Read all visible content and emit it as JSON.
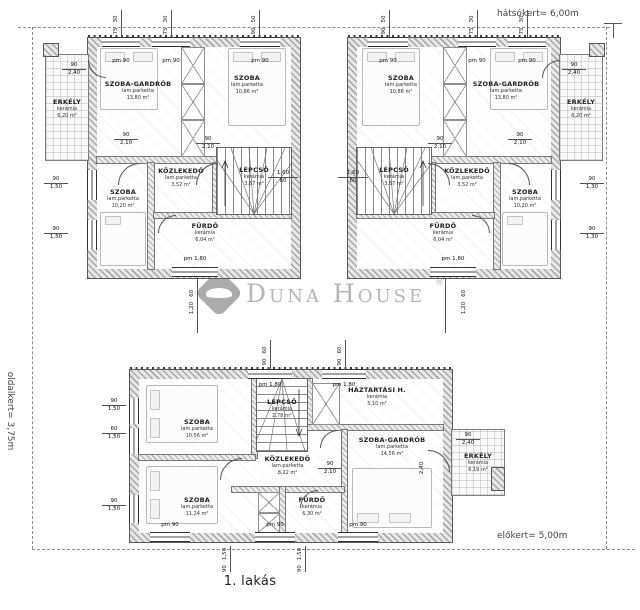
{
  "site": {
    "back_garden": "hátsókert= 6,00m",
    "side_garden": "oldalkert= 3,75m",
    "front_garden": "előkert= 5,00m",
    "unit": "1. lakás"
  },
  "watermark": {
    "brand": "Duna House",
    "reg": "®"
  },
  "rooms": {
    "ul": {
      "erkely": {
        "name": "ERKÉLY",
        "mat": "kerámia",
        "area": "6,20 m²"
      },
      "gardrob": {
        "name": "SZOBA-GARDRÓB",
        "mat": "lam.parketta",
        "area": "13,80 m²"
      },
      "szoba_top": {
        "name": "SZOBA",
        "mat": "lam.parketta",
        "area": "10,86 m²"
      },
      "kozlekedo": {
        "name": "KÖZLEKEDŐ",
        "mat": "lam.parketta",
        "area": "3,52 m²"
      },
      "lepcso": {
        "name": "LÉPCSŐ",
        "mat": "kerámia",
        "area": "3,67 m²"
      },
      "szoba_bottom": {
        "name": "SZOBA",
        "mat": "lam.parketta",
        "area": "10,20 m²"
      },
      "furdo": {
        "name": "FÜRDŐ",
        "mat": "kerámia",
        "area": "6,04 m²"
      }
    },
    "ur": {
      "erkely": {
        "name": "ERKÉLY",
        "mat": "kerámia",
        "area": "6,20 m²"
      },
      "gardrob": {
        "name": "SZOBA-GARDRÓB",
        "mat": "lam.parketta",
        "area": "13,80 m²"
      },
      "szoba_top": {
        "name": "SZOBA",
        "mat": "lam.parketta",
        "area": "10,86 m²"
      },
      "kozlekedo": {
        "name": "KÖZLEKEDŐ",
        "mat": "lam.parketta",
        "area": "3,52 m²"
      },
      "lepcso": {
        "name": "LÉPCSŐ",
        "mat": "kerámia",
        "area": "3,67 m²"
      },
      "szoba_bottom": {
        "name": "SZOBA",
        "mat": "lam.parketta",
        "area": "10,20 m²"
      },
      "furdo": {
        "name": "FÜRDŐ",
        "mat": "kerámia",
        "area": "6,04 m²"
      }
    },
    "low": {
      "szoba_nw": {
        "name": "SZOBA",
        "mat": "lam.parketta",
        "area": "10,56 m²"
      },
      "lepcso": {
        "name": "LÉPCSŐ",
        "mat": "kerámia",
        "area": "2,78 m²"
      },
      "haztartasi": {
        "name": "HÁZTARTÁSI H.",
        "mat": "kerámia",
        "area": "5,10 m²"
      },
      "kozlekedo": {
        "name": "KÖZLEKEDŐ",
        "mat": "lam.parketta",
        "area": "8,22 m²"
      },
      "szoba_sw": {
        "name": "SZOBA",
        "mat": "lam.parketta",
        "area": "11,24 m²"
      },
      "furdo": {
        "name": "FÜRDŐ",
        "mat": "kerámia",
        "area": "6,30 m²"
      },
      "gardrob": {
        "name": "SZOBA-GARDRÓB",
        "mat": "lam.parketta",
        "area": "14,56 m²"
      },
      "erkely": {
        "name": "ERKÉLY",
        "mat": "kerámia",
        "area": "6,19 m²"
      }
    }
  },
  "dims": {
    "pm90": "pm 90",
    "pm180": "pm 1,80",
    "d90": "90",
    "d60": "60",
    "d75": "75",
    "d30": "30",
    "d50": "50",
    "d120": "1,20",
    "d130": "1,30",
    "d150": "1,50",
    "d160": "1,60",
    "d210": "2,10",
    "d240": "2,40"
  }
}
